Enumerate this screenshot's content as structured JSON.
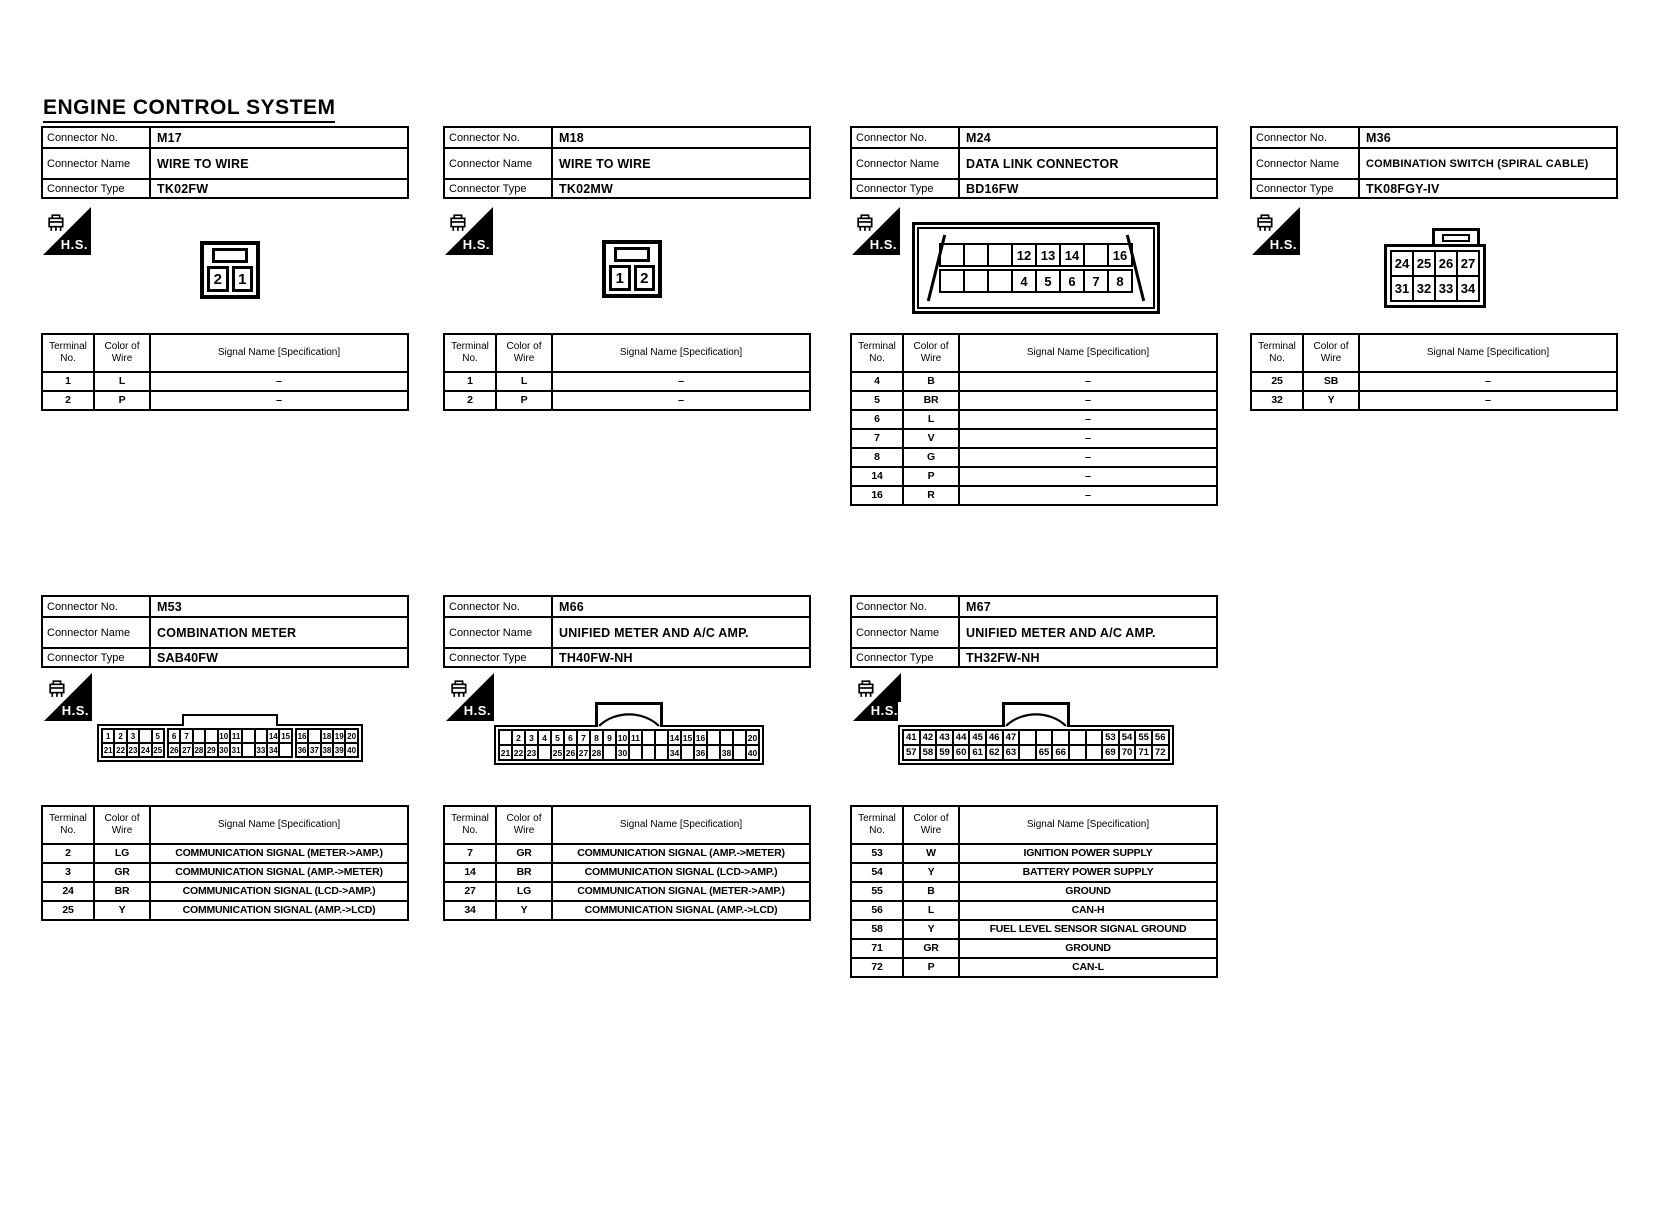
{
  "page": {
    "title": "ENGINE CONTROL SYSTEM"
  },
  "labels": {
    "connector_no": "Connector No.",
    "connector_name": "Connector Name",
    "connector_type": "Connector Type",
    "terminal_no": "Terminal No.",
    "color_of_wire": "Color of Wire",
    "signal_name": "Signal Name [Specification]",
    "hs_badge": "H.S."
  },
  "connectors": [
    {
      "no": "M17",
      "name": "WIRE TO WIRE",
      "type": "TK02FW",
      "diagram": {
        "cells": [
          "2",
          "1"
        ]
      },
      "terminals": [
        [
          "1",
          "L",
          "–"
        ],
        [
          "2",
          "P",
          "–"
        ]
      ]
    },
    {
      "no": "M18",
      "name": "WIRE TO WIRE",
      "type": "TK02MW",
      "diagram": {
        "cells": [
          "1",
          "2"
        ]
      },
      "terminals": [
        [
          "1",
          "L",
          "–"
        ],
        [
          "2",
          "P",
          "–"
        ]
      ]
    },
    {
      "no": "M24",
      "name": "DATA LINK CONNECTOR",
      "type": "BD16FW",
      "diagram": {
        "rows": [
          [
            "",
            "",
            "",
            "12",
            "13",
            "14",
            "",
            "16"
          ],
          [
            "",
            "",
            "",
            "4",
            "5",
            "6",
            "7",
            "8"
          ]
        ]
      },
      "terminals": [
        [
          "4",
          "B",
          "–"
        ],
        [
          "5",
          "BR",
          "–"
        ],
        [
          "6",
          "L",
          "–"
        ],
        [
          "7",
          "V",
          "–"
        ],
        [
          "8",
          "G",
          "–"
        ],
        [
          "14",
          "P",
          "–"
        ],
        [
          "16",
          "R",
          "–"
        ]
      ]
    },
    {
      "no": "M36",
      "name": "COMBINATION SWITCH (SPIRAL CABLE)",
      "type": "TK08FGY-IV",
      "diagram": {
        "rows": [
          [
            "24",
            "25",
            "26",
            "27"
          ],
          [
            "31",
            "32",
            "33",
            "34"
          ]
        ]
      },
      "terminals": [
        [
          "25",
          "SB",
          "–"
        ],
        [
          "32",
          "Y",
          "–"
        ]
      ]
    },
    {
      "no": "M53",
      "name": "COMBINATION METER",
      "type": "SAB40FW",
      "diagram": {
        "rows": [
          [
            "1",
            "2",
            "3",
            "",
            "5",
            "6",
            "7",
            "",
            "",
            "10",
            "11",
            "",
            "",
            "14",
            "15",
            "16",
            "",
            "18",
            "19",
            "20"
          ],
          [
            "21",
            "22",
            "23",
            "24",
            "25",
            "26",
            "27",
            "28",
            "29",
            "30",
            "31",
            "",
            "33",
            "34",
            "",
            "36",
            "37",
            "38",
            "39",
            "40"
          ]
        ]
      },
      "terminals": [
        [
          "2",
          "LG",
          "COMMUNICATION SIGNAL (METER->AMP.)"
        ],
        [
          "3",
          "GR",
          "COMMUNICATION SIGNAL (AMP.->METER)"
        ],
        [
          "24",
          "BR",
          "COMMUNICATION SIGNAL (LCD->AMP.)"
        ],
        [
          "25",
          "Y",
          "COMMUNICATION SIGNAL (AMP.->LCD)"
        ]
      ]
    },
    {
      "no": "M66",
      "name": "UNIFIED METER AND A/C AMP.",
      "type": "TH40FW-NH",
      "diagram": {
        "rows": [
          [
            "",
            "2",
            "3",
            "4",
            "5",
            "6",
            "7",
            "8",
            "9",
            "10",
            "11",
            "",
            "",
            "14",
            "15",
            "16",
            "",
            "",
            "",
            "20"
          ],
          [
            "21",
            "22",
            "23",
            "",
            "25",
            "26",
            "27",
            "28",
            "",
            "30",
            "",
            "",
            "",
            "34",
            "",
            "36",
            "",
            "38",
            "",
            "40"
          ]
        ]
      },
      "terminals": [
        [
          "7",
          "GR",
          "COMMUNICATION SIGNAL (AMP.->METER)"
        ],
        [
          "14",
          "BR",
          "COMMUNICATION SIGNAL (LCD->AMP.)"
        ],
        [
          "27",
          "LG",
          "COMMUNICATION SIGNAL (METER->AMP.)"
        ],
        [
          "34",
          "Y",
          "COMMUNICATION SIGNAL (AMP.->LCD)"
        ]
      ]
    },
    {
      "no": "M67",
      "name": "UNIFIED METER AND A/C AMP.",
      "type": "TH32FW-NH",
      "diagram": {
        "rows": [
          [
            "41",
            "42",
            "43",
            "44",
            "45",
            "46",
            "47",
            "",
            "",
            "",
            "",
            "",
            "53",
            "54",
            "55",
            "56"
          ],
          [
            "57",
            "58",
            "59",
            "60",
            "61",
            "62",
            "63",
            "",
            "65",
            "66",
            "",
            "",
            "69",
            "70",
            "71",
            "72"
          ]
        ]
      },
      "terminals": [
        [
          "53",
          "W",
          "IGNITION POWER SUPPLY"
        ],
        [
          "54",
          "Y",
          "BATTERY POWER SUPPLY"
        ],
        [
          "55",
          "B",
          "GROUND"
        ],
        [
          "56",
          "L",
          "CAN-H"
        ],
        [
          "58",
          "Y",
          "FUEL LEVEL SENSOR SIGNAL GROUND"
        ],
        [
          "71",
          "GR",
          "GROUND"
        ],
        [
          "72",
          "P",
          "CAN-L"
        ]
      ]
    }
  ]
}
